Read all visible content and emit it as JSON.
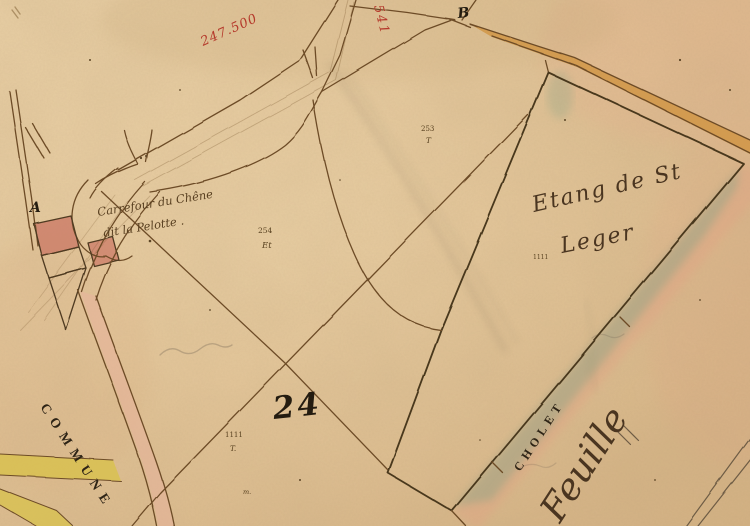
{
  "map": {
    "red_grid_annotations": {
      "horizontal": "247.500",
      "vertical": "541"
    },
    "junction_letters": {
      "a": "A",
      "b": "B"
    },
    "labels": {
      "crossroads_line1": "Carrefour du Chêne",
      "crossroads_line2": "dit la Pelotte .",
      "pond_line1": "Etang de St",
      "pond_line2": "Leger",
      "commune": "COMMUNE",
      "neighbor_sheet_line1": "CHOLET",
      "neighbor_sheet_line2": "Feuille"
    },
    "numbers": {
      "section": "24",
      "parcel_253": "253",
      "parcel_253_code": "T",
      "parcel_254": "254",
      "parcel_254_code": "Et",
      "parcel_1111": "1111",
      "parcel_1111_code": "T.",
      "small_1111": "1111",
      "marker_m": "m."
    },
    "colors": {
      "paper": "#ddbd90",
      "ink_brown": "#6d4c28",
      "ink_dark": "#2e2315",
      "ink_red": "#b5392b",
      "road_orange": "#cf9440",
      "road_pink": "#e8b39c",
      "road_yellow": "#d8c24a",
      "pond_green": "#88a384",
      "sheet_edge_pink": "#e2a183",
      "building_red": "#cd7f6a"
    }
  }
}
